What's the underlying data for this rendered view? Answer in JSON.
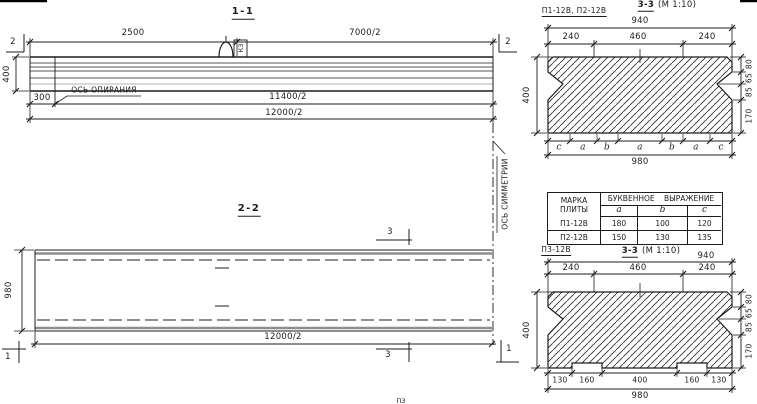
{
  "colors": {
    "ink": "#1c1c1c",
    "paper": "#ffffff"
  },
  "section_1_1": {
    "title": "1-1",
    "dims": {
      "top_left": "2500",
      "top_right": "7000/2",
      "height": "400",
      "overhang": "300",
      "half_span": "11400/2",
      "half_length": "12000/2"
    },
    "support_axis_label": "ОСЬ ОПИРАНИЯ",
    "loop_tag": "К3",
    "cut_marker_left": "2",
    "cut_marker_right": "2"
  },
  "symmetry_axis_label": "ОСЬ СИММЕТРИИ",
  "section_2_2": {
    "title": "2-2",
    "dims": {
      "width": "980",
      "half_length": "12000/2"
    },
    "cut_marker_3_top": "3",
    "cut_marker_3_bottom": "3",
    "cut_marker_1_left": "1",
    "cut_marker_1_right": "1"
  },
  "section_3_3_top": {
    "plates_label": "П1-12В, П2-12В",
    "title": "3-3",
    "scale": "(М 1:10)",
    "dims": {
      "top_total": "940",
      "top_segments": [
        "240",
        "460",
        "240"
      ],
      "height": "400",
      "right_segments": [
        "80",
        "65",
        "85",
        "170"
      ],
      "bottom_letters": [
        "c",
        "a",
        "b",
        "a",
        "b",
        "a",
        "c"
      ],
      "bottom_total": "980"
    }
  },
  "table": {
    "col1_header": "МАРКА\nПЛИТЫ",
    "group_header": "БУКВЕННОЕ ВЫРАЖЕНИЕ",
    "sub_headers": [
      "a",
      "b",
      "c"
    ],
    "rows": [
      {
        "mark": "П1-12В",
        "a": "180",
        "b": "100",
        "c": "120"
      },
      {
        "mark": "П2-12В",
        "a": "150",
        "b": "130",
        "c": "135"
      }
    ]
  },
  "section_3_3_bottom": {
    "plate_label": "П3-12В",
    "title": "3-3",
    "scale": "(М 1:10)",
    "dims": {
      "top_total": "940",
      "top_segments": [
        "240",
        "460",
        "240"
      ],
      "height": "400",
      "right_segments": [
        "80",
        "65",
        "85",
        "170"
      ],
      "bottom_segments": [
        "130",
        "160",
        "400",
        "160",
        "130"
      ],
      "bottom_total": "980"
    }
  },
  "fragment_text": "ПЗ"
}
